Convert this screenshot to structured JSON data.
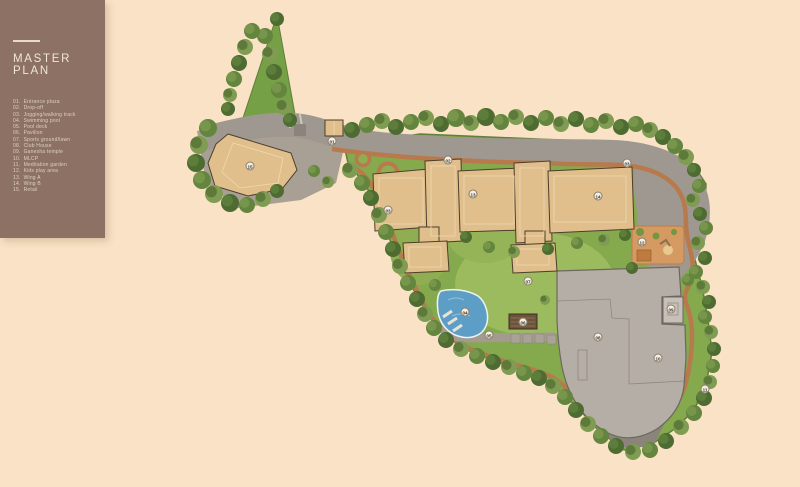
{
  "sidebar": {
    "title": "MASTER PLAN",
    "legend": [
      {
        "num": "01.",
        "label": "Entrance plaza"
      },
      {
        "num": "02.",
        "label": "Drop-off"
      },
      {
        "num": "03.",
        "label": "Jogging/walking track"
      },
      {
        "num": "04.",
        "label": "Swimming pool"
      },
      {
        "num": "05.",
        "label": "Pool deck"
      },
      {
        "num": "06.",
        "label": "Pavilion"
      },
      {
        "num": "07.",
        "label": "Sports ground/lawn"
      },
      {
        "num": "08.",
        "label": "Club House"
      },
      {
        "num": "09.",
        "label": "Ganesha temple"
      },
      {
        "num": "10.",
        "label": "MLCP"
      },
      {
        "num": "11.",
        "label": "Meditation garden"
      },
      {
        "num": "12.",
        "label": "Kids play area"
      },
      {
        "num": "13.",
        "label": "Wing A"
      },
      {
        "num": "14.",
        "label": "Wing B"
      },
      {
        "num": "15.",
        "label": "Retail"
      }
    ]
  },
  "map": {
    "markers": [
      {
        "num": "01",
        "name": "entrance-plaza",
        "x": 332,
        "y": 141
      },
      {
        "num": "02",
        "name": "drop-off",
        "x": 448,
        "y": 160
      },
      {
        "num": "03",
        "name": "jogging-track-a",
        "x": 388,
        "y": 210
      },
      {
        "num": "03",
        "name": "jogging-track-b",
        "x": 627,
        "y": 163
      },
      {
        "num": "04",
        "name": "swimming-pool",
        "x": 465,
        "y": 312
      },
      {
        "num": "05",
        "name": "pool-deck",
        "x": 489,
        "y": 335
      },
      {
        "num": "06",
        "name": "pavilion",
        "x": 523,
        "y": 322
      },
      {
        "num": "07",
        "name": "sports-ground-lawn",
        "x": 528,
        "y": 281
      },
      {
        "num": "08",
        "name": "club-house",
        "x": 598,
        "y": 337
      },
      {
        "num": "09",
        "name": "ganesha-temple",
        "x": 671,
        "y": 309
      },
      {
        "num": "10",
        "name": "mlcp",
        "x": 658,
        "y": 358
      },
      {
        "num": "11",
        "name": "meditation-garden",
        "x": 705,
        "y": 389
      },
      {
        "num": "12",
        "name": "kids-play-area",
        "x": 642,
        "y": 242
      },
      {
        "num": "13",
        "name": "wing-a",
        "x": 473,
        "y": 194
      },
      {
        "num": "14",
        "name": "wing-b",
        "x": 598,
        "y": 196
      },
      {
        "num": "15",
        "name": "retail",
        "x": 250,
        "y": 166
      }
    ]
  },
  "colors": {
    "bg": "#f9e2c5",
    "sidebar_bg": "#8c7164",
    "sidebar_title": "#f1e6d4",
    "legend_text": "#ded1bd",
    "road": "#9e9890",
    "road_dark": "#8b847b",
    "pad": "#a8a094",
    "grass": "#85a94d",
    "grass_light": "#9cba5e",
    "grass_edge": "#5f7f3a",
    "wedge": "#76a046",
    "tree_dark": "#4e6c31",
    "tree_mid": "#64853e",
    "tree_light": "#7f9c52",
    "building": "#e0bf8d",
    "building_shade": "#caa267",
    "building_stroke": "#4c3d2a",
    "gray_building": "#b5aea6",
    "gray_stroke": "#6e6760",
    "pool": "#5d9ec6",
    "pool_light": "#8abbd8",
    "track": "#b87a4d",
    "play": "#d59a61",
    "marker_bg": "#f4efe4",
    "marker_border": "#8a7d6a",
    "marker_text": "#3a3224"
  }
}
